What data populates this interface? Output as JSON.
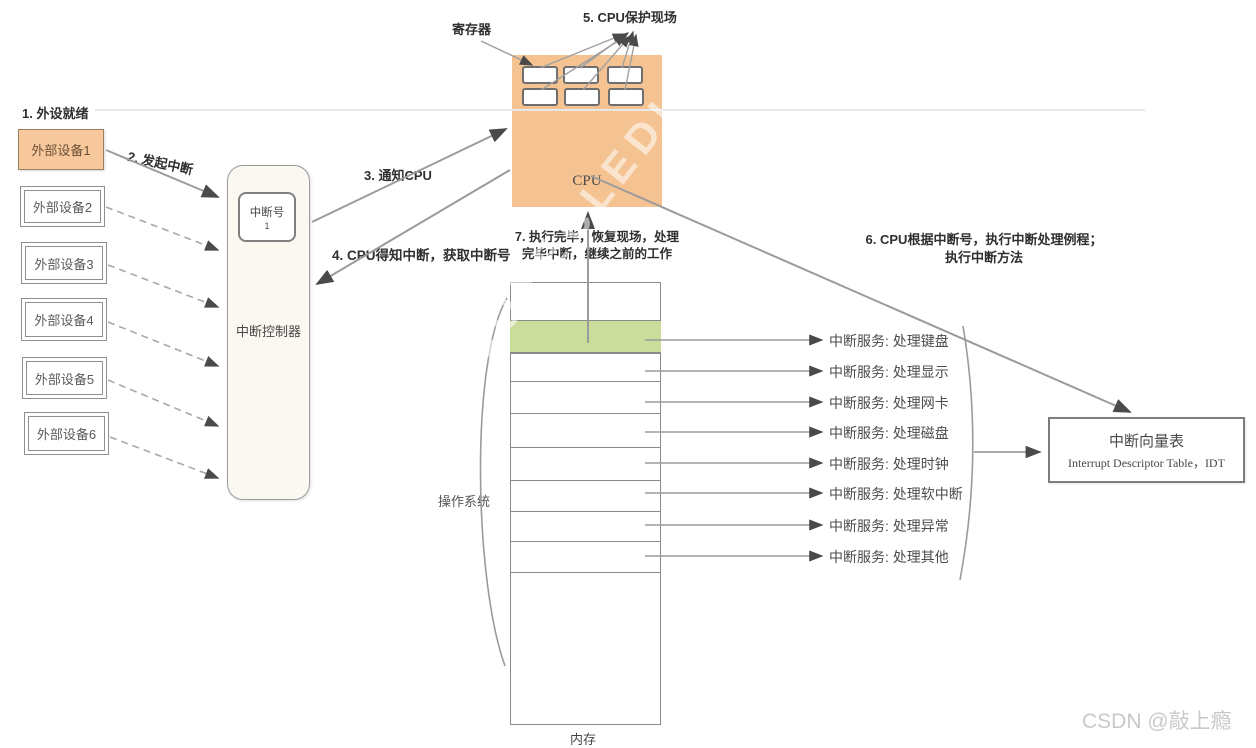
{
  "labels": {
    "step1": "1. 外设就绪",
    "step2": "2. 发起中断",
    "step3": "3. 通知CPU",
    "step4": "4. CPU得知中断，获取中断号",
    "step5": "5. CPU保护现场",
    "step6_line1": "6. CPU根据中断号，执行中断处理例程；",
    "step6_line2": "执行中断方法",
    "step7_line1": "7. 执行完毕，恢复现场，处理",
    "step7_line2": "完毕中断，继续之前的工作",
    "register_caption": "寄存器"
  },
  "devices": {
    "items": [
      "外部设备1",
      "外部设备2",
      "外部设备3",
      "外部设备4",
      "外部设备5",
      "外部设备6"
    ]
  },
  "controller": {
    "title": "中断控制器",
    "number_box_label": "中断号",
    "number_box_value": "1"
  },
  "cpu": {
    "title": "CPU"
  },
  "memory": {
    "caption": "内存",
    "os_brace_label": "操作系统",
    "services": [
      "中断服务: 处理键盘",
      "中断服务: 处理显示",
      "中断服务: 处理网卡",
      "中断服务: 处理磁盘",
      "中断服务: 处理时钟",
      "中断服务: 处理软中断",
      "中断服务: 处理异常",
      "中断服务: 处理其他"
    ]
  },
  "idt": {
    "title": "中断向量表",
    "subtitle": "Interrupt Descriptor Table，IDT"
  },
  "watermarks": {
    "diagonal": "COYECLEDI",
    "credit": "CSDN @敲上瘾"
  },
  "colors": {
    "cpu_fill": "#f5c392",
    "device1_fill": "#f7c89c",
    "highlight_row": "#cbdd9a",
    "controller_fill": "#faf8f0",
    "line": "#9b9b9b"
  }
}
